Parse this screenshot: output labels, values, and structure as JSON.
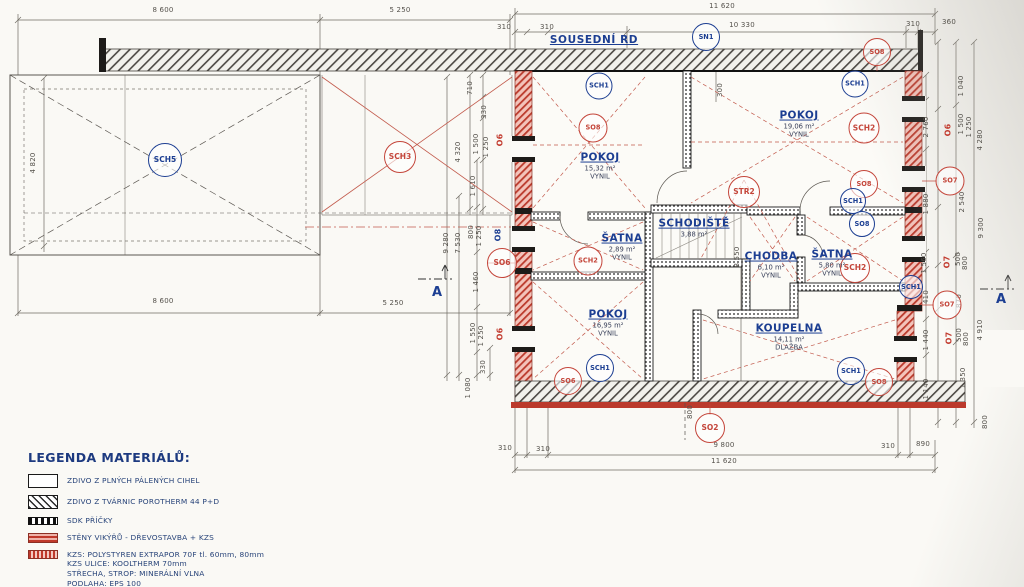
{
  "labels": {
    "neighbor": "SOUSEDNÍ RD",
    "section": "A"
  },
  "colors": {
    "accent_red": "#c23a2e",
    "accent_blue": "#1c3e92",
    "wall_red": "#bb3a2c"
  },
  "rooms": [
    {
      "name": "POKOJ",
      "area": "15,32 m²",
      "floor": "VYNIL",
      "x": 600,
      "y": 166
    },
    {
      "name": "POKOJ",
      "area": "19,06 m²",
      "floor": "VYNIL",
      "x": 799,
      "y": 124
    },
    {
      "name": "ŠATNA",
      "area": "2,89 m²",
      "floor": "VYNIL",
      "x": 622,
      "y": 247
    },
    {
      "name": "SCHODIŠTĚ",
      "area": "3,88 m²",
      "floor": "",
      "x": 694,
      "y": 228
    },
    {
      "name": "CHODBA",
      "area": "6,10 m²",
      "floor": "VYNIL",
      "x": 771,
      "y": 265
    },
    {
      "name": "ŠATNA",
      "area": "5,80 m²",
      "floor": "VYNIL",
      "x": 832,
      "y": 263
    },
    {
      "name": "POKOJ",
      "area": "16,95 m²",
      "floor": "VYNIL",
      "x": 608,
      "y": 323
    },
    {
      "name": "KOUPELNA",
      "area": "14,11 m²",
      "floor": "DLAŽBA",
      "x": 789,
      "y": 337
    }
  ],
  "circles": [
    {
      "t": "SCH5",
      "x": 165,
      "y": 160,
      "c": "blue",
      "s": 32
    },
    {
      "t": "SCH3",
      "x": 400,
      "y": 157,
      "c": "red",
      "s": 30
    },
    {
      "t": "SN1",
      "x": 706,
      "y": 37,
      "c": "blue",
      "s": 26
    },
    {
      "t": "SO8",
      "x": 877,
      "y": 52,
      "c": "red",
      "s": 26
    },
    {
      "t": "SCH1",
      "x": 599,
      "y": 86,
      "c": "blue",
      "s": 25
    },
    {
      "t": "SCH1",
      "x": 855,
      "y": 84,
      "c": "blue",
      "s": 25
    },
    {
      "t": "SO8",
      "x": 593,
      "y": 128,
      "c": "red",
      "s": 27
    },
    {
      "t": "SCH2",
      "x": 864,
      "y": 128,
      "c": "red",
      "s": 29
    },
    {
      "t": "SO8",
      "x": 864,
      "y": 184,
      "c": "red",
      "s": 26
    },
    {
      "t": "SCH1",
      "x": 853,
      "y": 201,
      "c": "blue",
      "s": 24
    },
    {
      "t": "SO8",
      "x": 862,
      "y": 224,
      "c": "blue",
      "s": 24
    },
    {
      "t": "STR2",
      "x": 744,
      "y": 192,
      "c": "red",
      "s": 30
    },
    {
      "t": "SCH2",
      "x": 588,
      "y": 261,
      "c": "red",
      "s": 27
    },
    {
      "t": "SO6",
      "x": 502,
      "y": 263,
      "c": "red",
      "s": 28
    },
    {
      "t": "SCH2",
      "x": 855,
      "y": 268,
      "c": "red",
      "s": 28
    },
    {
      "t": "SCH1",
      "x": 911,
      "y": 287,
      "c": "blue",
      "s": 22
    },
    {
      "t": "SO7",
      "x": 950,
      "y": 181,
      "c": "red",
      "s": 27
    },
    {
      "t": "SO7",
      "x": 947,
      "y": 305,
      "c": "red",
      "s": 27
    },
    {
      "t": "SCH1",
      "x": 600,
      "y": 368,
      "c": "blue",
      "s": 26
    },
    {
      "t": "SO6",
      "x": 568,
      "y": 381,
      "c": "red",
      "s": 26
    },
    {
      "t": "SCH1",
      "x": 851,
      "y": 371,
      "c": "blue",
      "s": 26
    },
    {
      "t": "SO8",
      "x": 879,
      "y": 382,
      "c": "red",
      "s": 26
    },
    {
      "t": "SO2",
      "x": 710,
      "y": 428,
      "c": "red",
      "s": 28
    }
  ],
  "dims": [
    {
      "t": "8 600",
      "x": 163,
      "y": 10
    },
    {
      "t": "5 250",
      "x": 400,
      "y": 10
    },
    {
      "t": "11 620",
      "x": 722,
      "y": 6
    },
    {
      "t": "310",
      "x": 504,
      "y": 27
    },
    {
      "t": "310",
      "x": 547,
      "y": 27
    },
    {
      "t": "10 330",
      "x": 742,
      "y": 25
    },
    {
      "t": "310",
      "x": 913,
      "y": 24
    },
    {
      "t": "360",
      "x": 949,
      "y": 22
    },
    {
      "t": "300",
      "x": 720,
      "y": 90,
      "r": 1
    },
    {
      "t": "4 820",
      "x": 33,
      "y": 163,
      "r": 1
    },
    {
      "t": "8 600",
      "x": 163,
      "y": 301
    },
    {
      "t": "5 250",
      "x": 393,
      "y": 303
    },
    {
      "t": "710",
      "x": 470,
      "y": 88,
      "r": 1
    },
    {
      "t": "330",
      "x": 484,
      "y": 112,
      "r": 1
    },
    {
      "t": "1 500",
      "x": 476,
      "y": 144,
      "r": 1
    },
    {
      "t": "1 250",
      "x": 486,
      "y": 147,
      "r": 1
    },
    {
      "t": "O6",
      "x": 500,
      "y": 140,
      "r": 1,
      "c": "red",
      "b": 1
    },
    {
      "t": "4 320",
      "x": 458,
      "y": 152,
      "r": 1
    },
    {
      "t": "1 610",
      "x": 473,
      "y": 186,
      "r": 1
    },
    {
      "t": "9 280",
      "x": 446,
      "y": 243,
      "r": 1
    },
    {
      "t": "7 530",
      "x": 458,
      "y": 243,
      "r": 1
    },
    {
      "t": "800",
      "x": 471,
      "y": 232,
      "r": 1
    },
    {
      "t": "1 250",
      "x": 479,
      "y": 236,
      "r": 1
    },
    {
      "t": "O8",
      "x": 498,
      "y": 235,
      "r": 1,
      "c": "blue",
      "b": 1
    },
    {
      "t": "1 460",
      "x": 476,
      "y": 282,
      "r": 1
    },
    {
      "t": "1 550",
      "x": 473,
      "y": 333,
      "r": 1
    },
    {
      "t": "1 250",
      "x": 481,
      "y": 336,
      "r": 1
    },
    {
      "t": "O6",
      "x": 500,
      "y": 334,
      "r": 1,
      "c": "red",
      "b": 1
    },
    {
      "t": "330",
      "x": 483,
      "y": 367,
      "r": 1
    },
    {
      "t": "1 080",
      "x": 468,
      "y": 388,
      "r": 1
    },
    {
      "t": "1 040",
      "x": 961,
      "y": 86,
      "r": 1
    },
    {
      "t": "2 760",
      "x": 926,
      "y": 127,
      "r": 1
    },
    {
      "t": "1 880",
      "x": 926,
      "y": 204,
      "r": 1
    },
    {
      "t": "1 560",
      "x": 924,
      "y": 263,
      "r": 1
    },
    {
      "t": "410",
      "x": 926,
      "y": 297,
      "r": 1
    },
    {
      "t": "1 440",
      "x": 926,
      "y": 340,
      "r": 1
    },
    {
      "t": "1 140",
      "x": 926,
      "y": 389,
      "r": 1
    },
    {
      "t": "1 500",
      "x": 961,
      "y": 124,
      "r": 1
    },
    {
      "t": "1 250",
      "x": 969,
      "y": 127,
      "r": 1
    },
    {
      "t": "O6",
      "x": 948,
      "y": 130,
      "r": 1,
      "c": "red",
      "b": 1
    },
    {
      "t": "4 280",
      "x": 980,
      "y": 140,
      "r": 1
    },
    {
      "t": "2 540",
      "x": 962,
      "y": 202,
      "r": 1
    },
    {
      "t": "9 300",
      "x": 981,
      "y": 228,
      "r": 1
    },
    {
      "t": "O7",
      "x": 947,
      "y": 262,
      "r": 1,
      "c": "red",
      "b": 1
    },
    {
      "t": "500",
      "x": 958,
      "y": 259,
      "r": 1
    },
    {
      "t": "800",
      "x": 965,
      "y": 263,
      "r": 1
    },
    {
      "t": "870",
      "x": 959,
      "y": 301,
      "r": 1
    },
    {
      "t": "O7",
      "x": 949,
      "y": 338,
      "r": 1,
      "c": "red",
      "b": 1
    },
    {
      "t": "500",
      "x": 959,
      "y": 335,
      "r": 1
    },
    {
      "t": "800",
      "x": 966,
      "y": 339,
      "r": 1
    },
    {
      "t": "4 910",
      "x": 980,
      "y": 330,
      "r": 1
    },
    {
      "t": "1 350",
      "x": 963,
      "y": 378,
      "r": 1
    },
    {
      "t": "800",
      "x": 985,
      "y": 422,
      "r": 1
    },
    {
      "t": "8 550",
      "x": 737,
      "y": 257,
      "r": 1
    },
    {
      "t": "800",
      "x": 690,
      "y": 412,
      "r": 1
    },
    {
      "t": "310",
      "x": 505,
      "y": 448
    },
    {
      "t": "310",
      "x": 543,
      "y": 449
    },
    {
      "t": "9 800",
      "x": 724,
      "y": 445
    },
    {
      "t": "310",
      "x": 888,
      "y": 446
    },
    {
      "t": "890",
      "x": 923,
      "y": 444
    },
    {
      "t": "11 620",
      "x": 724,
      "y": 461
    }
  ],
  "legend": {
    "title": "LEGENDA MATERIÁLŮ:",
    "items": [
      {
        "swatch": "plain",
        "lines": [
          "ZDIVO Z PLNÝCH PÁLENÝCH CIHEL"
        ]
      },
      {
        "swatch": "hatch",
        "lines": [
          "ZDIVO Z TVÁRNIC POROTHERM 44 P+D"
        ]
      },
      {
        "swatch": "dots",
        "lines": [
          "SDK PŘÍČKY"
        ]
      },
      {
        "swatch": "red",
        "lines": [
          "STĚNY VIKÝŘŮ - DŘEVOSTAVBA + KZS"
        ]
      },
      {
        "swatch": "redfine",
        "lines": [
          "KZS: POLYSTYREN EXTRAPOR 70F tl. 60mm, 80mm",
          "KZS ULICE: KOOLTHERM 70mm",
          "STŘECHA, STROP: MINERÁLNÍ VLNA",
          "PODLAHA: EPS 100"
        ]
      },
      {
        "swatch": "gray",
        "lines": [
          "ZATEPLENÍ MIMO OBÁLKU VYTÁPĚNÉ ZÓNY DOMU."
        ]
      }
    ]
  }
}
